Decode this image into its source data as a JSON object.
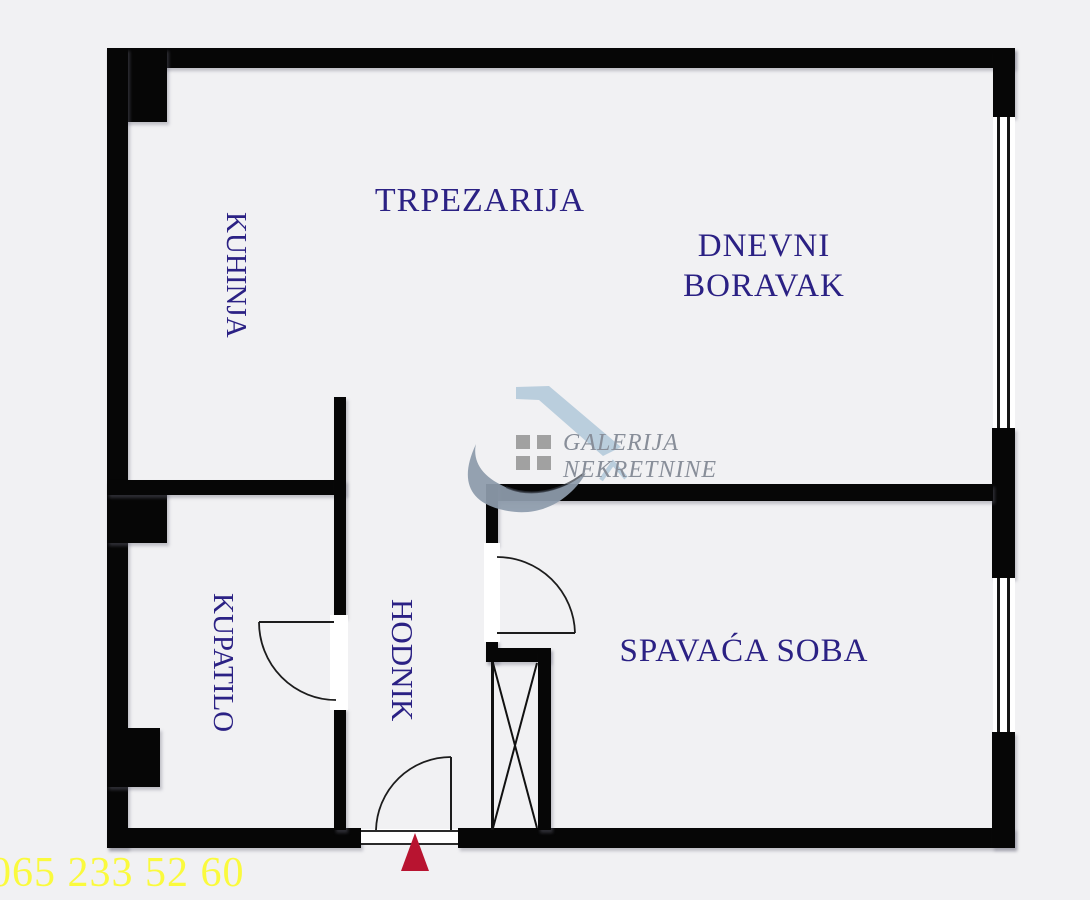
{
  "rooms": {
    "kitchen": "KUHINJA",
    "dining_room": "TRPEZARIJA",
    "living_room_line1": "DNEVNI",
    "living_room_line2": "BORAVAK",
    "bathroom": "KUPATILO",
    "hallway": "HODNIK",
    "bedroom": "SPAVAĆA SOBA"
  },
  "watermark": {
    "brand_line1": "GALERIJA",
    "brand_line2": "NEKRETNINE"
  },
  "contact": {
    "phone": "065 233 52 60"
  },
  "colors": {
    "background": "#f1f1f3",
    "wall": "#060606",
    "room_label": "#2b2184",
    "phone_text": "#fafa3d",
    "entrance_marker": "#b81430",
    "watermark_text": "#888e99",
    "watermark_swoosh": "#8e9cac",
    "watermark_roof": "#b6ccdc",
    "watermark_squares": "#9b9b9b"
  }
}
